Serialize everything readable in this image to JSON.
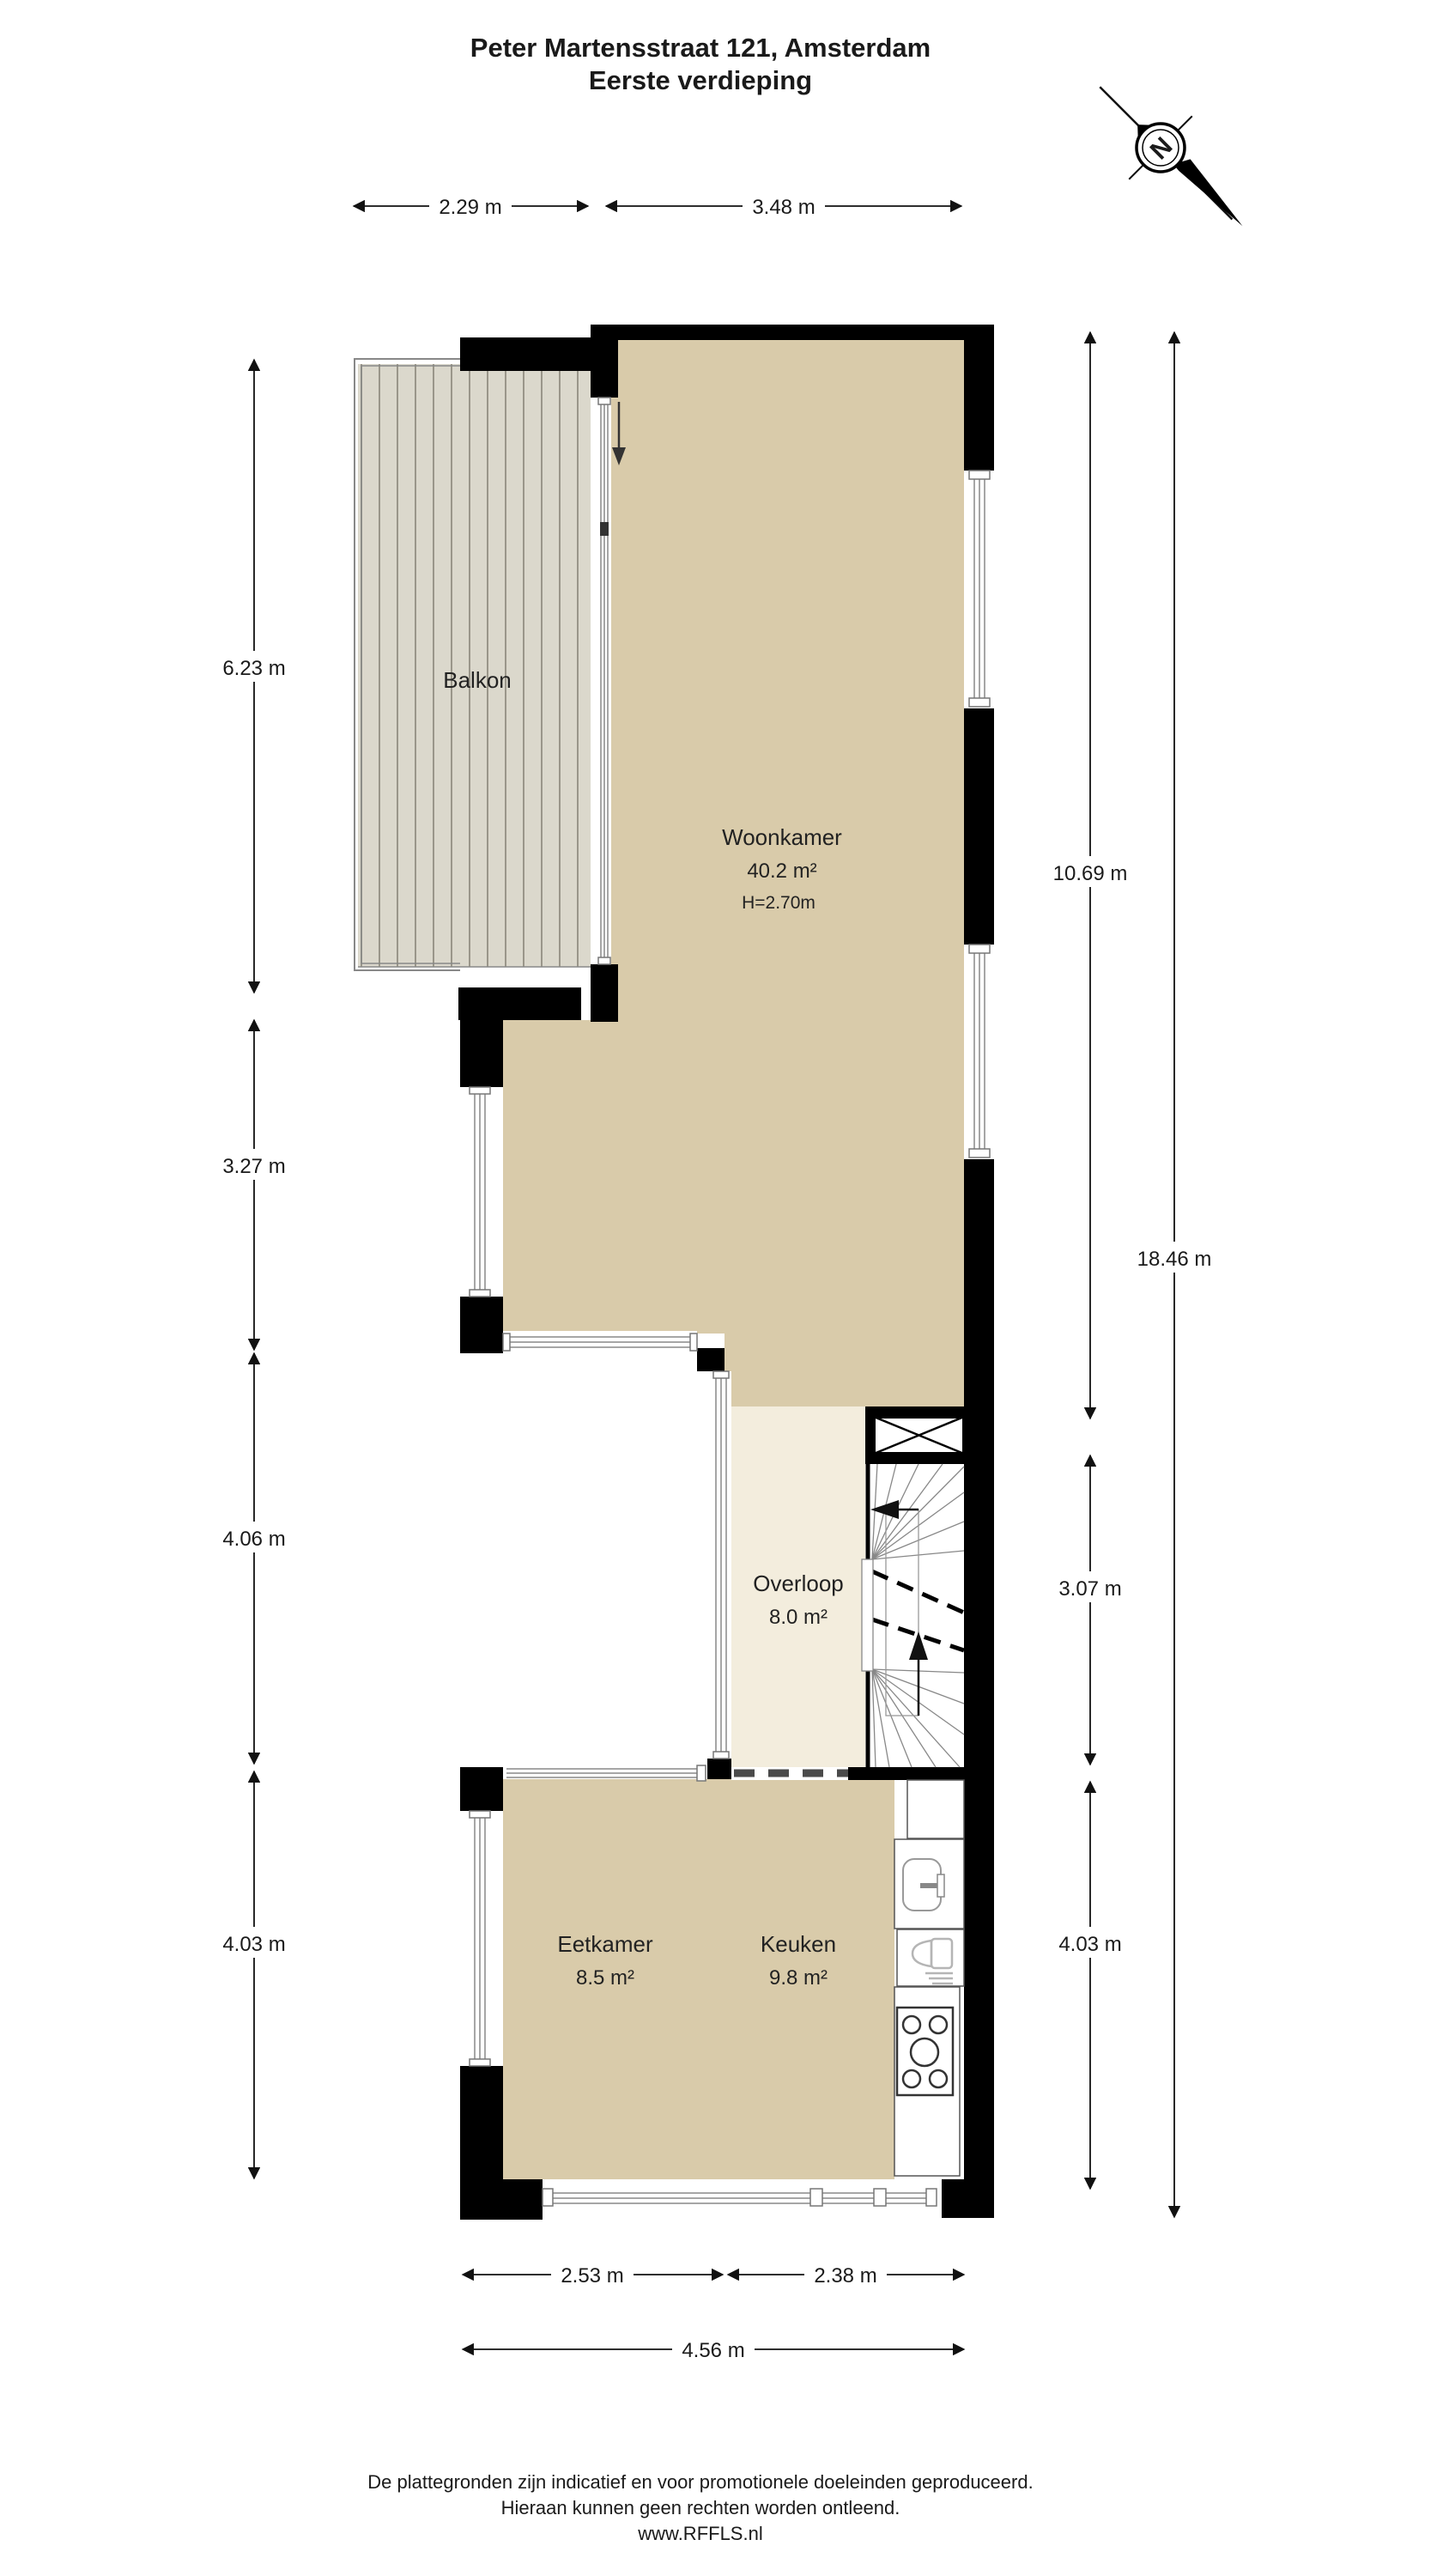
{
  "title": {
    "line1": "Peter Martensstraat 121, Amsterdam",
    "line2": "Eerste verdieping"
  },
  "compass": {
    "label": "N"
  },
  "rooms": {
    "balkon": {
      "name": "Balkon"
    },
    "woonkamer": {
      "name": "Woonkamer",
      "area": "40.2 m²",
      "ceiling": "H=2.70m"
    },
    "overloop": {
      "name": "Overloop",
      "area": "8.0 m²"
    },
    "eetkamer": {
      "name": "Eetkamer",
      "area": "8.5 m²"
    },
    "keuken": {
      "name": "Keuken",
      "area": "9.8 m²"
    }
  },
  "dimensions": {
    "top_balcony": "2.29 m",
    "top_living": "3.48 m",
    "left_balcony": "6.23 m",
    "left_living": "3.27 m",
    "left_landing": "4.06 m",
    "left_dining": "4.03 m",
    "right_living": "10.69 m",
    "right_landing": "3.07 m",
    "right_kitchen": "4.03 m",
    "right_total": "18.46 m",
    "bottom_dining": "2.53 m",
    "bottom_kitchen": "2.38 m",
    "bottom_total": "4.56 m"
  },
  "footer": {
    "line1": "De plattegronden zijn indicatief en voor promotionele doeleinden geproduceerd.",
    "line2": "Hieraan kunnen geen rechten worden ontleend.",
    "line3": "www.RFFLS.nl"
  },
  "colors": {
    "wall": "#000000",
    "floor": "#d9cbaa",
    "landing_floor": "#f3eddd",
    "deck": "#dbd8cc",
    "deck_stripe": "#9a968a",
    "outline": "#888888"
  }
}
